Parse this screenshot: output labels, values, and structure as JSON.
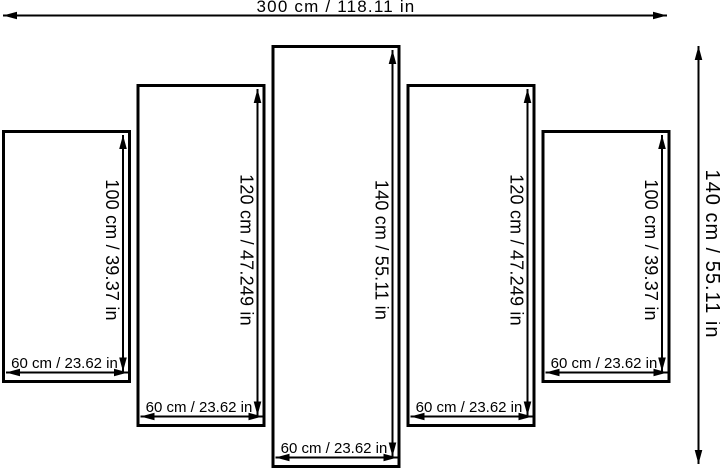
{
  "diagram": {
    "description_name": "five-panel-canvas-size-diagram",
    "overall": {
      "width_label": "300 cm / 118.11 in",
      "height_label": "140 cm / 55.11 in"
    },
    "panels": [
      {
        "height_label": "100 cm / 39.37 in",
        "width_label": "60 cm / 23.62 in"
      },
      {
        "height_label": "120 cm / 47.249 in",
        "width_label": "60 cm / 23.62 in"
      },
      {
        "height_label": "140 cm / 55.11 in",
        "width_label": "60 cm / 23.62 in"
      },
      {
        "height_label": "120 cm / 47.249 in",
        "width_label": "60 cm / 23.62 in"
      },
      {
        "height_label": "100 cm / 39.37 in",
        "width_label": "60 cm / 23.62 in"
      }
    ],
    "colors": {
      "line": "#000000",
      "background": "#ffffff"
    }
  }
}
